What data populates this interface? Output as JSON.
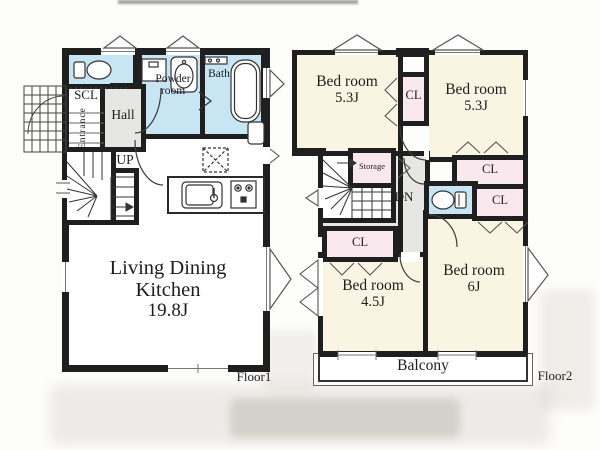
{
  "colors": {
    "wall": "#1f1f1f",
    "wet_area": "#c7e5f3",
    "bedroom": "#faf5e2",
    "closet": "#f9e9ef",
    "hallway": "#e6e7e4"
  },
  "floor1": {
    "floor_label": "Floor1",
    "scl_label": "SCL",
    "entrance_label": "Entrance",
    "hall_label": "Hall",
    "powder_label": "Powder room",
    "bath_label": "Bath",
    "up_label": "UP",
    "ldk_name": "Living Dining Kitchen",
    "ldk_area": "19.8J"
  },
  "floor2": {
    "floor_label": "Floor2",
    "bedrooms": [
      {
        "name": "Bed room",
        "area": "5.3J"
      },
      {
        "name": "Bed room",
        "area": "5.3J"
      },
      {
        "name": "Bed room",
        "area": "4.5J"
      },
      {
        "name": "Bed room",
        "area": "6J"
      }
    ],
    "closet_label": "CL",
    "storage_label": "Storage",
    "dn_label": "DN",
    "balcony_label": "Balcony"
  }
}
